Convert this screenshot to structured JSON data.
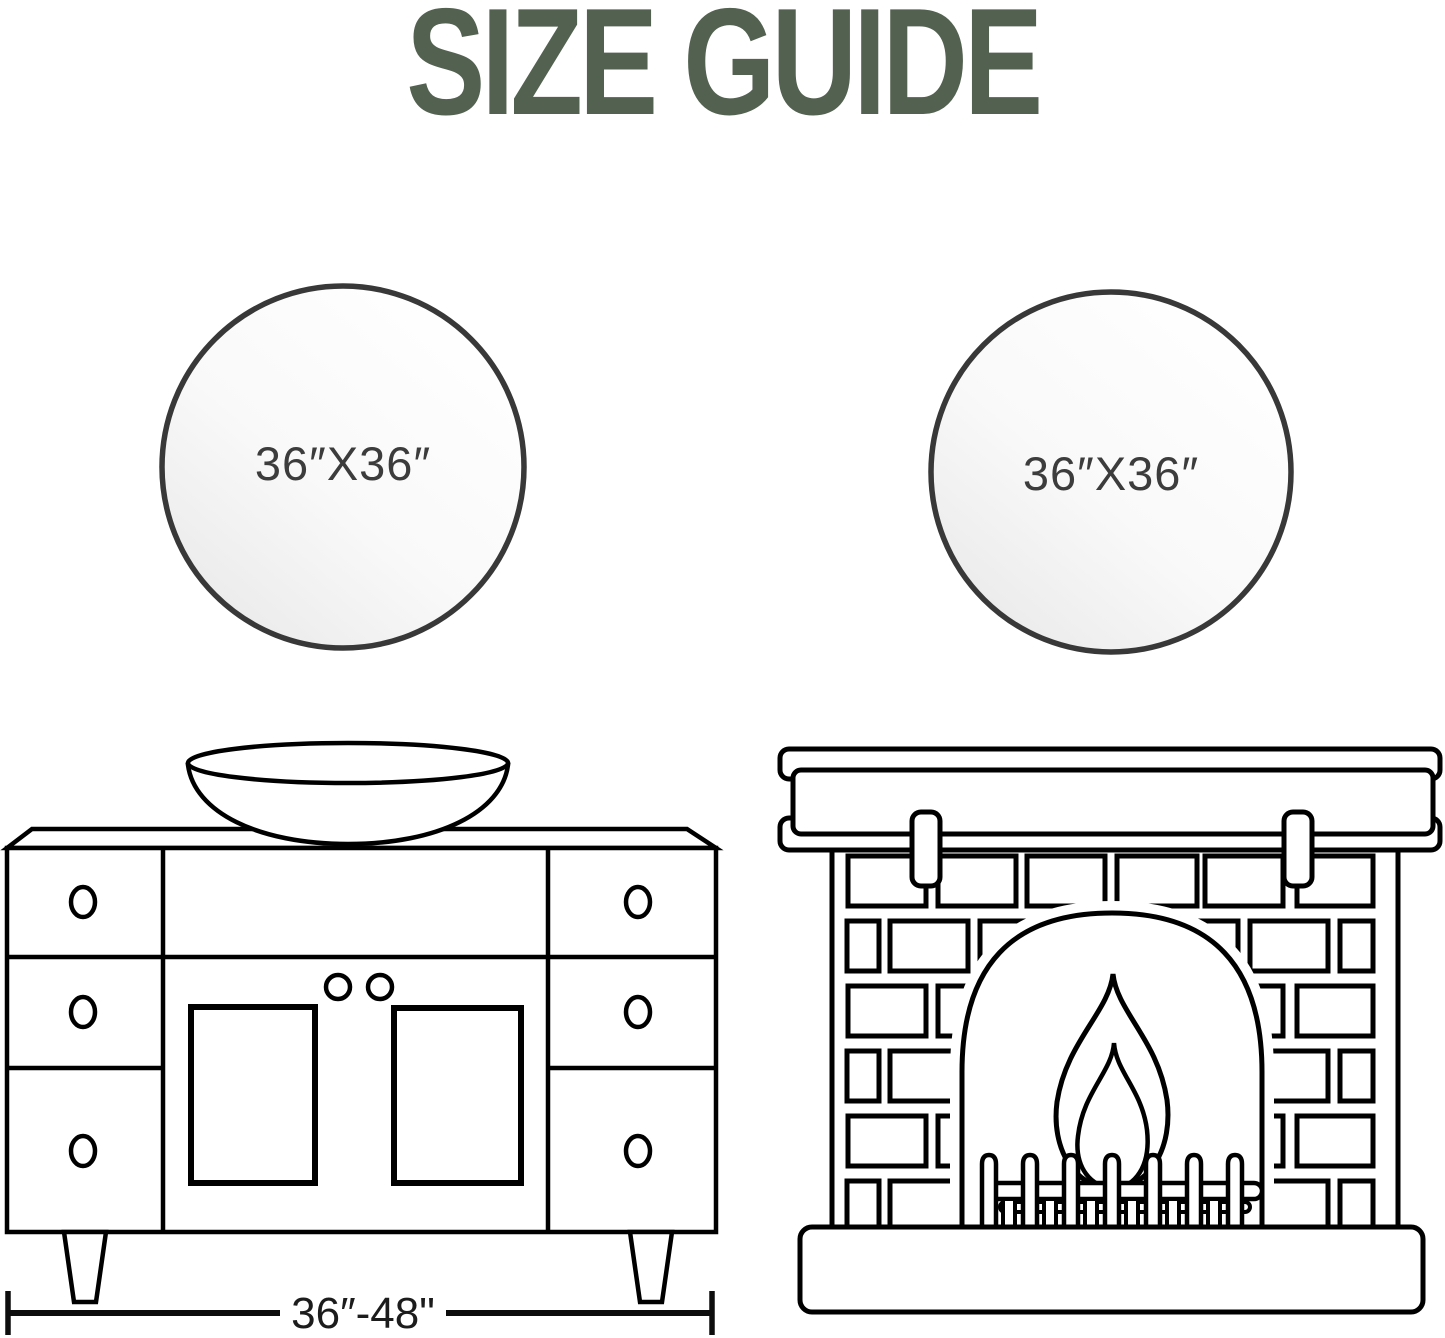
{
  "header": {
    "title": "SIZE GUIDE",
    "title_color": "#536150"
  },
  "mirrors": {
    "left": {
      "label": "36″X36″"
    },
    "right": {
      "label": "36″X36″"
    }
  },
  "vanity": {
    "dimension_label": "36″-48\""
  },
  "colors": {
    "line": "#000000",
    "mirror_rim": "#383838",
    "label_text": "#3c3c3c",
    "dimension_text": "#1c1c1c"
  },
  "icons": [
    "round-mirror-icon",
    "vessel-sink-icon",
    "vanity-cabinet-icon",
    "fireplace-icon",
    "flame-icon",
    "dimension-line-icon"
  ]
}
